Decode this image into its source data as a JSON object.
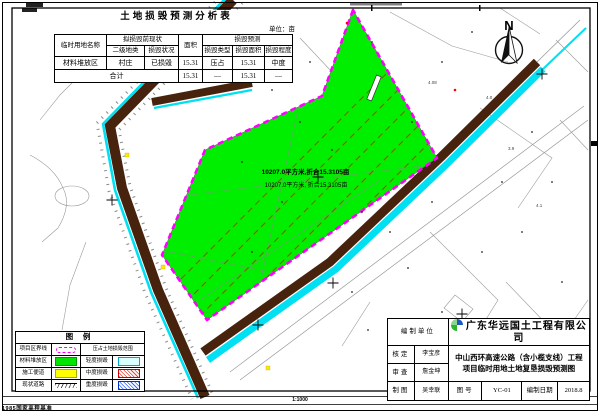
{
  "table": {
    "title": "土地损毁预测分析表",
    "unit": "单位：亩",
    "h": {
      "name": "临时用地名称",
      "pre": "拟损毁前现状",
      "cls": "二级地类",
      "status": "损毁状况",
      "area": "面积",
      "pred": "损毁预测",
      "type": "损毁类型",
      "darea": "损毁面积",
      "degree": "损毁程度"
    },
    "r1": {
      "name": "材料堆放区",
      "cls": "村庄",
      "status": "已损毁",
      "area": "15.31",
      "type": "压占",
      "darea": "15.31",
      "degree": "中度"
    },
    "r2": {
      "name": "合计",
      "area": "15.31",
      "type": "—",
      "darea": "15.31",
      "degree": "—"
    }
  },
  "legend": {
    "title": "图 例",
    "r1_left": "项目区界线",
    "r1_right": "压占土地损毁范围",
    "r2_left": "材料堆放区",
    "r2_right": "轻度损毁",
    "r3_left": "施工便道",
    "r3_right": "中度损毁",
    "r4_left": "现状道路",
    "r4_right": "重度损毁"
  },
  "annotation": {
    "line1": "10207.0平方米,折合15.3105亩",
    "line2": "10207.0平方米, 折合15.3105亩"
  },
  "compass": {
    "label": "N"
  },
  "frame": {
    "scale": "1:1000",
    "datum_note": "1985国家高程基准"
  },
  "spots": {
    "s1": "4.08",
    "s2": "4.0",
    "s3": "3.9",
    "s4": "4.1"
  },
  "title_block": {
    "org_label": "编制单位",
    "org": "广东华远国土工程有限公司",
    "approve_label": "核定",
    "approve": "李宝彦",
    "review_label": "审查",
    "review": "詹金坤",
    "draft_label": "制图",
    "draft": "吴幸联",
    "project_line1": "中山西环高速公路（含小榄支线）工程",
    "project_line2": "项目临时用地土地复垦损毁预测图",
    "fig_label": "图号",
    "fig_no": "YC-01",
    "date_label": "编制日期",
    "date": "2018.8"
  },
  "colors": {
    "area_fill": "#00ee00",
    "boundary": "#ff00ff",
    "road": "#47230e",
    "water": "#00e0f2",
    "hatch": "#d83000"
  }
}
